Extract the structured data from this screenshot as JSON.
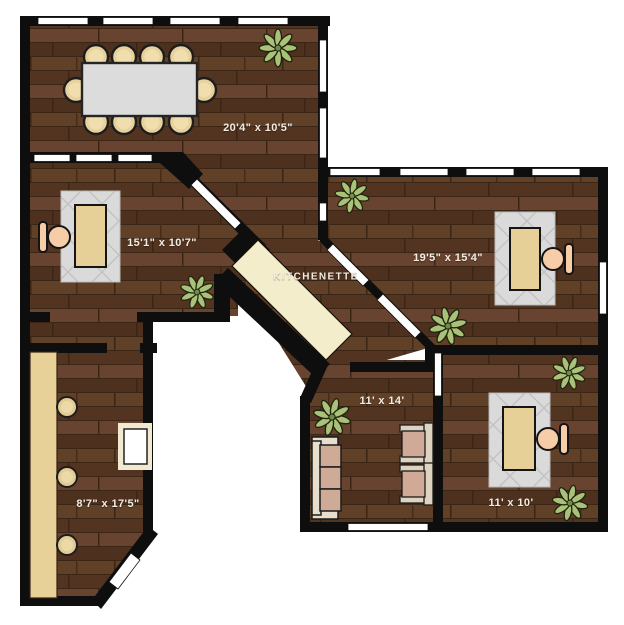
{
  "page": {
    "title": "Office Floor Plan"
  },
  "rooms": {
    "conference": {
      "label": "20'4\" x 10'5\""
    },
    "office_left": {
      "label": "15'1\" x 10'7\""
    },
    "kitchenette": {
      "label": "KITCHENETTE"
    },
    "office_right": {
      "label": "19'5\" x 15'4\""
    },
    "lounge": {
      "label": "11' x 14'"
    },
    "office_small": {
      "label": "11' x 10'"
    },
    "bar": {
      "label": "8'7\" x 17'5\""
    }
  },
  "colors": {
    "background": "#ffffff",
    "wall": "#0e0e0e",
    "floor_wood": "#5a3a25",
    "window": "#ffffff",
    "counter": "#f3edcb",
    "bar_counter": "#e8d099",
    "desk": "#e7d098",
    "rug": "#dadada",
    "conference_table": "#dcdcdc",
    "conference_chair": "#e7d19c",
    "office_chair": "#f7cda8",
    "sofa_cushion": "#cfab97",
    "sofa_frame": "#e7dfcc",
    "plant": "#a9c178"
  }
}
